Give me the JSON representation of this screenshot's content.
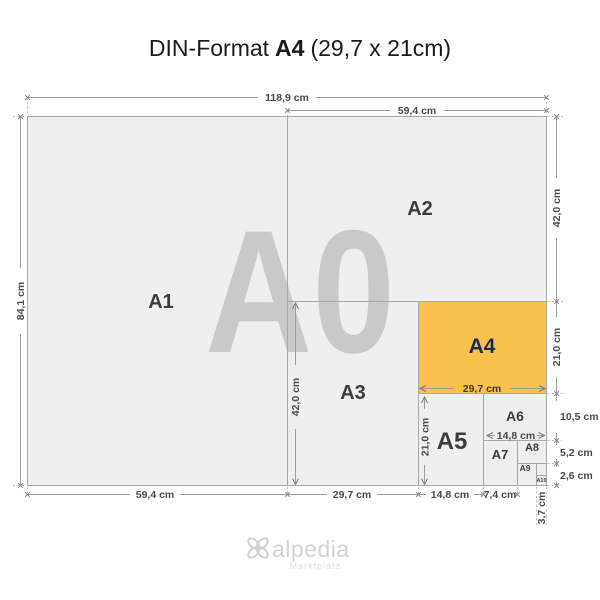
{
  "title": {
    "prefix": "DIN-Format",
    "format_name": "A4",
    "format_size": "(29,7 x 21cm)"
  },
  "watermark": "A0",
  "labels": {
    "a1": "A1",
    "a2": "A2",
    "a3": "A3",
    "a4": "A4",
    "a5": "A5",
    "a6": "A6",
    "a7": "A7",
    "a8": "A8",
    "a9": "A9",
    "a10": "A10"
  },
  "dims": {
    "top": {
      "a0_width": "118,9 cm",
      "a2_width": "59,4 cm"
    },
    "left": {
      "a0_height": "84,1 cm"
    },
    "right": {
      "a2_height": "42,0 cm",
      "a4_height": "21,0 cm",
      "a6_height": "10,5 cm",
      "a8_height": "5,2 cm",
      "a10_height": "2,6 cm"
    },
    "bottom": {
      "a1_width": "59,4 cm",
      "a3_width": "29,7 cm",
      "a5_width": "14,8 cm",
      "a7_width": "7,4 cm",
      "a9_width": "3,7 cm"
    },
    "inner": {
      "a3_height": "42,0 cm",
      "a5_height": "21,0 cm",
      "a4_width": "29,7 cm",
      "a6_width": "14,8 cm"
    }
  },
  "logo": {
    "name": "alpedia",
    "tagline": "Marktplatz"
  },
  "colors": {
    "highlight": "#FAC14D",
    "paper": "#EFEFEF",
    "a4_label": "#1C2B4D",
    "watermark": "#C9C9CA"
  }
}
